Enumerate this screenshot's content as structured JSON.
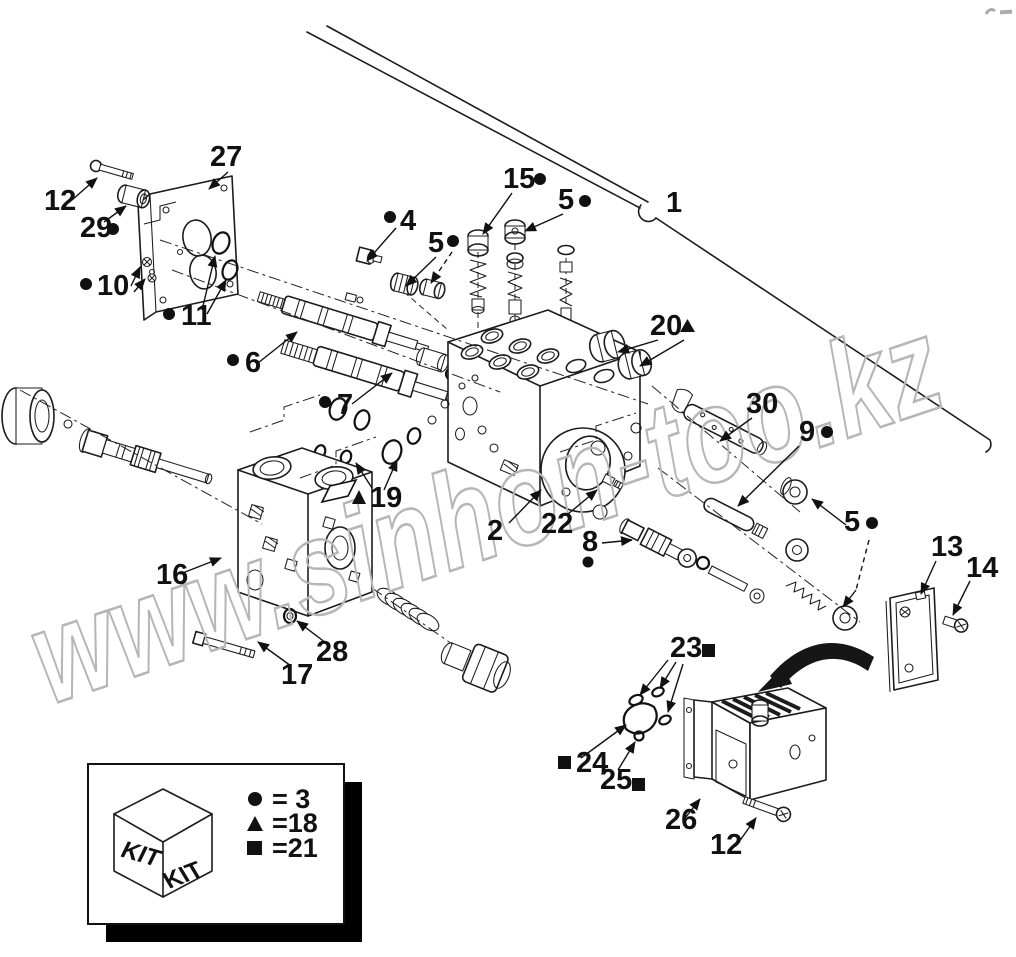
{
  "figure": {
    "background": "#ffffff",
    "line_color": "#1c1c1c",
    "watermark_color": "#b6b6b6"
  },
  "watermark": {
    "text": "www.sinhon-too.kz"
  },
  "callouts": {
    "c1": {
      "label": "1",
      "symbol": null
    },
    "c2": {
      "label": "2",
      "symbol": null
    },
    "c4": {
      "label": "4",
      "symbol": "dot"
    },
    "c5a": {
      "label": "5",
      "symbol": "dot"
    },
    "c5b": {
      "label": "5",
      "symbol": "dot"
    },
    "c5c": {
      "label": "5",
      "symbol": "dot"
    },
    "c6": {
      "label": "6",
      "symbol": "dot"
    },
    "c7": {
      "label": "7",
      "symbol": "dot"
    },
    "c8": {
      "label": "8",
      "symbol": "dot"
    },
    "c9": {
      "label": "9",
      "symbol": "dot"
    },
    "c10": {
      "label": "10",
      "symbol": "dot"
    },
    "c11": {
      "label": "11",
      "symbol": "dot"
    },
    "c12a": {
      "label": "12",
      "symbol": null
    },
    "c12b": {
      "label": "12",
      "symbol": null
    },
    "c13": {
      "label": "13",
      "symbol": null
    },
    "c14": {
      "label": "14",
      "symbol": null
    },
    "c15": {
      "label": "15",
      "symbol": "dot"
    },
    "c16": {
      "label": "16",
      "symbol": null
    },
    "c17": {
      "label": "17",
      "symbol": null
    },
    "c19": {
      "label": "19",
      "symbol": "triangle"
    },
    "c20": {
      "label": "20",
      "symbol": "triangle"
    },
    "c22": {
      "label": "22",
      "symbol": null
    },
    "c23": {
      "label": "23",
      "symbol": "square"
    },
    "c24": {
      "label": "24",
      "symbol": "square"
    },
    "c25": {
      "label": "25",
      "symbol": "square"
    },
    "c26": {
      "label": "26",
      "symbol": null
    },
    "c27": {
      "label": "27",
      "symbol": null
    },
    "c28": {
      "label": "28",
      "symbol": null
    },
    "c29": {
      "label": "29",
      "symbol": "dot"
    },
    "c30": {
      "label": "30",
      "symbol": null
    }
  },
  "legend": {
    "kit_face_left": "KIT",
    "kit_face_right": "KIT",
    "entries": [
      {
        "symbol": "dot",
        "label": "= 3"
      },
      {
        "symbol": "triangle",
        "label": "=18"
      },
      {
        "symbol": "square",
        "label": "=21"
      }
    ]
  }
}
